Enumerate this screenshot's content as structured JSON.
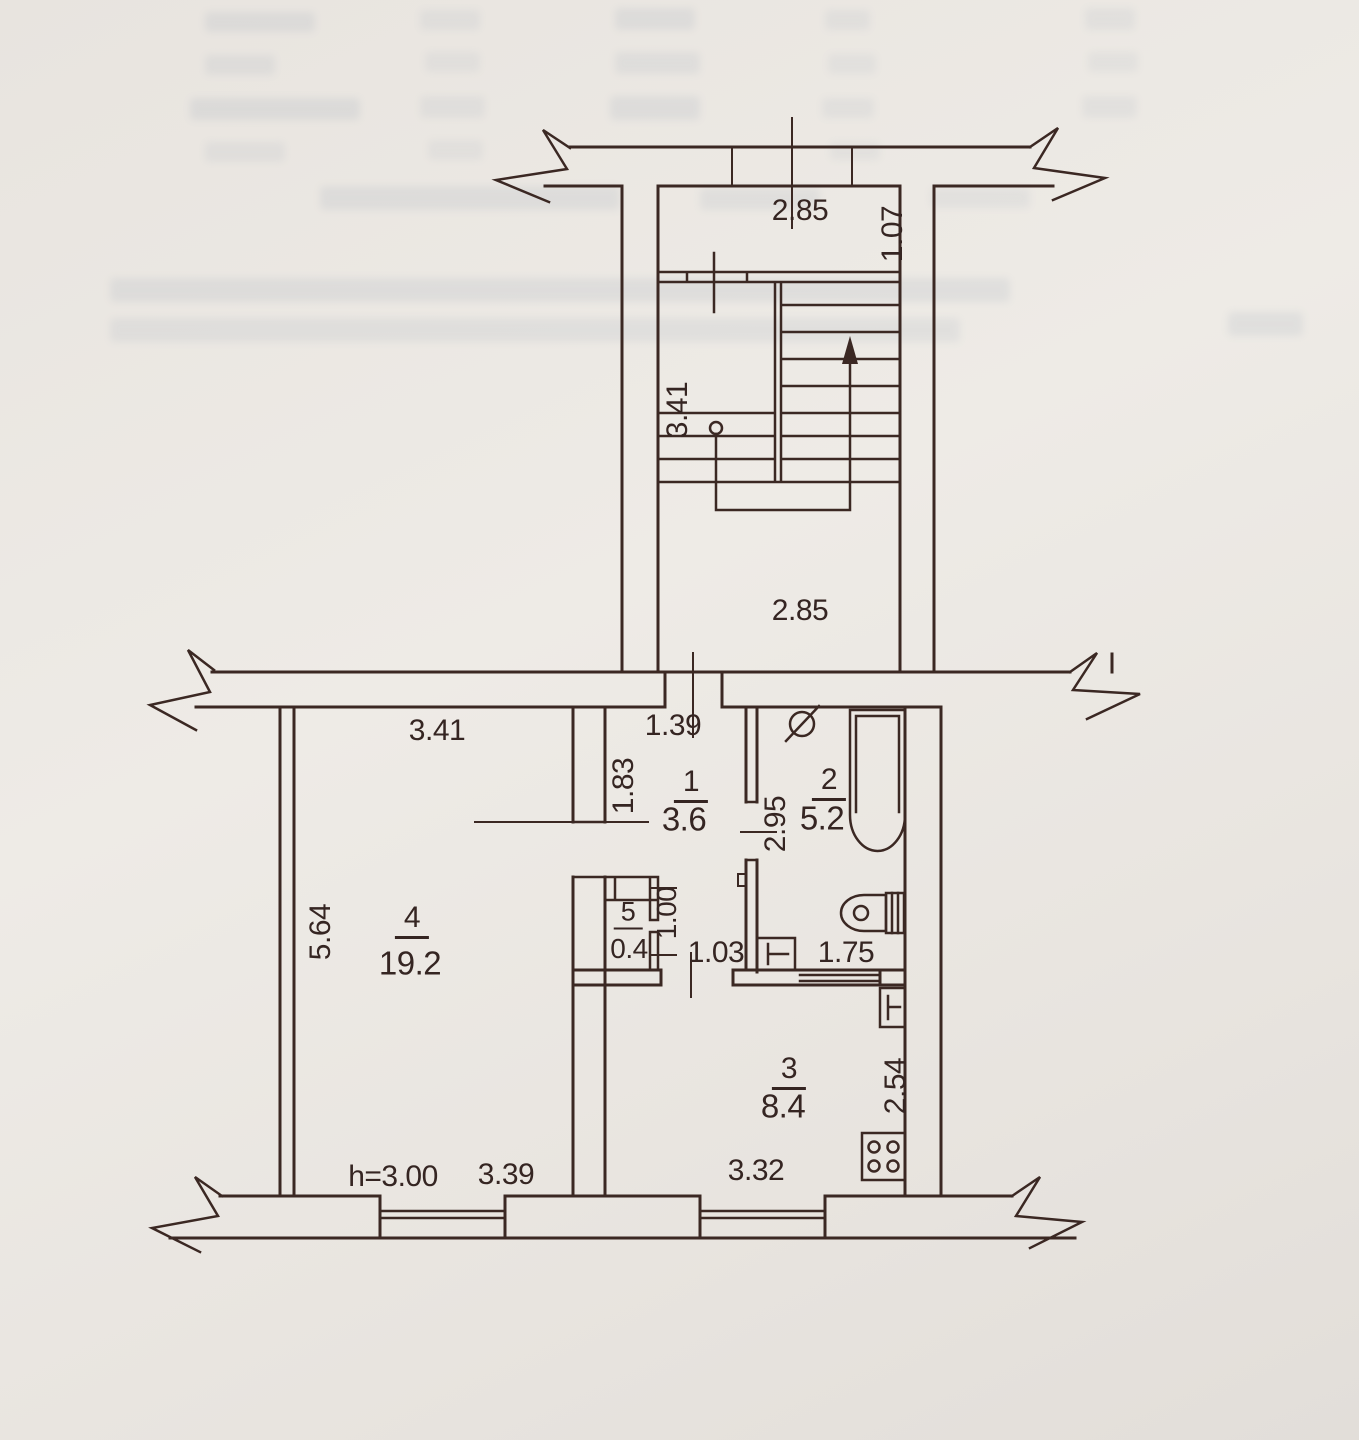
{
  "plan": {
    "rooms": [
      {
        "number": "1",
        "area": "3.6"
      },
      {
        "number": "2",
        "area": "5.2"
      },
      {
        "number": "3",
        "area": "8.4"
      },
      {
        "number": "4",
        "area": "19.2"
      },
      {
        "number": "5",
        "area": "0.4"
      }
    ],
    "dimensions": {
      "stair_top_width": "2.85",
      "stair_landing_depth": "1.07",
      "stair_flight_length": "3.41",
      "stair_bottom_width": "2.85",
      "room4_top_width": "3.41",
      "hallway_width": "1.39",
      "hallway_left_height": "1.83",
      "bathroom_left_height": "2.95",
      "room4_left_height": "5.64",
      "closet_height": "1.00",
      "hallway_bottom_door": "1.03",
      "bathroom_bottom_width": "1.75",
      "kitchen_right_height": "2.54",
      "kitchen_bottom_width": "3.32",
      "room4_bottom_width": "3.39",
      "ceiling_height": "h=3.00"
    },
    "symbols": {
      "valve": "shutoff-valve",
      "bathtub": "bathtub",
      "toilet": "toilet",
      "radiator": "radiator",
      "stove": "gas-stove",
      "stair_direction": "up-arrow",
      "break_mark": "wall-break"
    },
    "colors": {
      "ink": "#3b2823",
      "paper": "#eae6e1"
    }
  }
}
